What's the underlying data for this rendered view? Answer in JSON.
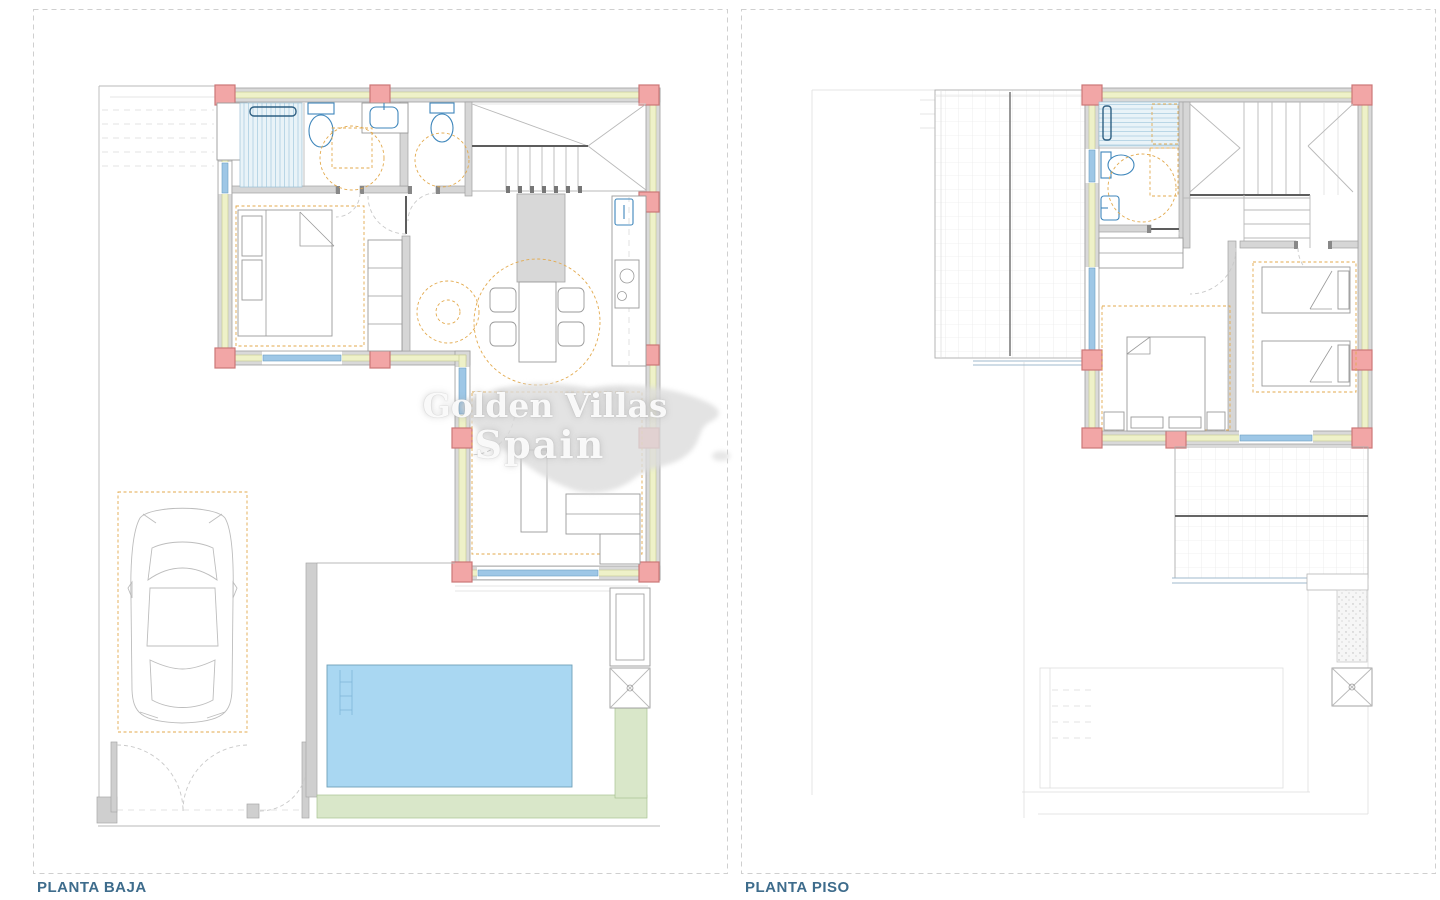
{
  "labels": {
    "left_plan": "PLANTA BAJA",
    "right_plan": "PLANTA PISO"
  },
  "watermark": {
    "line1": "Golden Villas",
    "line2": "Spain"
  },
  "colors": {
    "label": "#3e6c8c",
    "frame": "#cfcfcf",
    "wall": "#d9d9d9",
    "wall_stroke": "#9e9e9e",
    "insulation": "#eef1c8",
    "insulation_stroke": "#c3c98f",
    "column": "#f2a6a6",
    "column_stroke": "#cc7777",
    "glass": "#9ec7e6",
    "glass_stroke": "#6d9ec2",
    "fixture": "#3e86bb",
    "clearance": "#e3aa4e",
    "furniture": "#9a9a9a",
    "pool": "#a9d7f2",
    "pool_stroke": "#6f9fb8",
    "deck": "#d9e7c9",
    "deck_stroke": "#a9c492",
    "grid": "#e3e3e3",
    "dark": "#5d5d5d",
    "watermark": "#dcdcdc"
  }
}
